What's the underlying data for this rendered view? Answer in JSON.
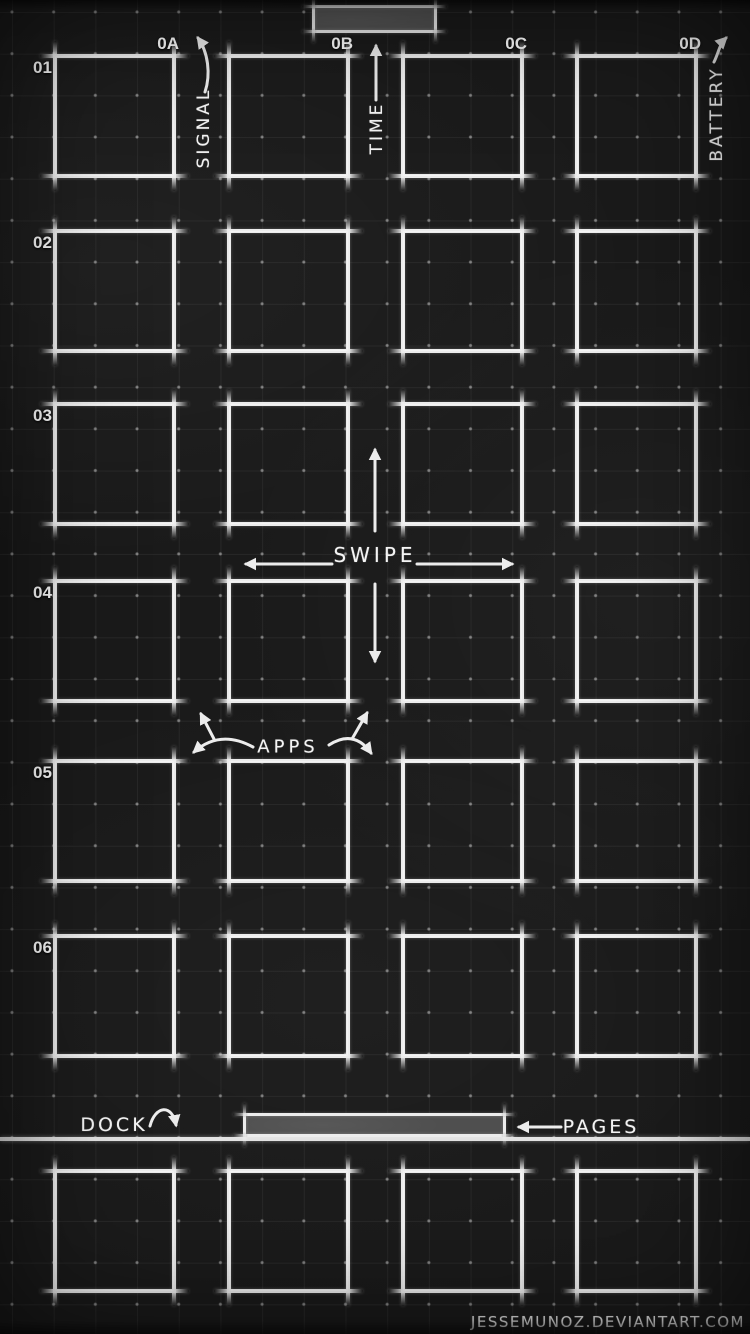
{
  "columns": [
    "0A",
    "0B",
    "0C",
    "0D"
  ],
  "rows": [
    "01",
    "02",
    "03",
    "04",
    "05",
    "06"
  ],
  "annotations": {
    "signal": "SIGNAL",
    "time": "TIME",
    "battery": "BATTERY",
    "swipe": "SWIPE",
    "apps": "APPS",
    "dock": "DOCK",
    "pages": "PAGES"
  },
  "credit": "JESSEMUNOZ.DEVIANTART.COM",
  "colors": {
    "background": "#1a1a1a",
    "frame_stroke": "#ececec",
    "bar_fill": "#4f4f4f",
    "circle_stroke": "rgba(255,255,255,0.38)",
    "grid_line": "rgba(255,255,255,0.055)"
  }
}
